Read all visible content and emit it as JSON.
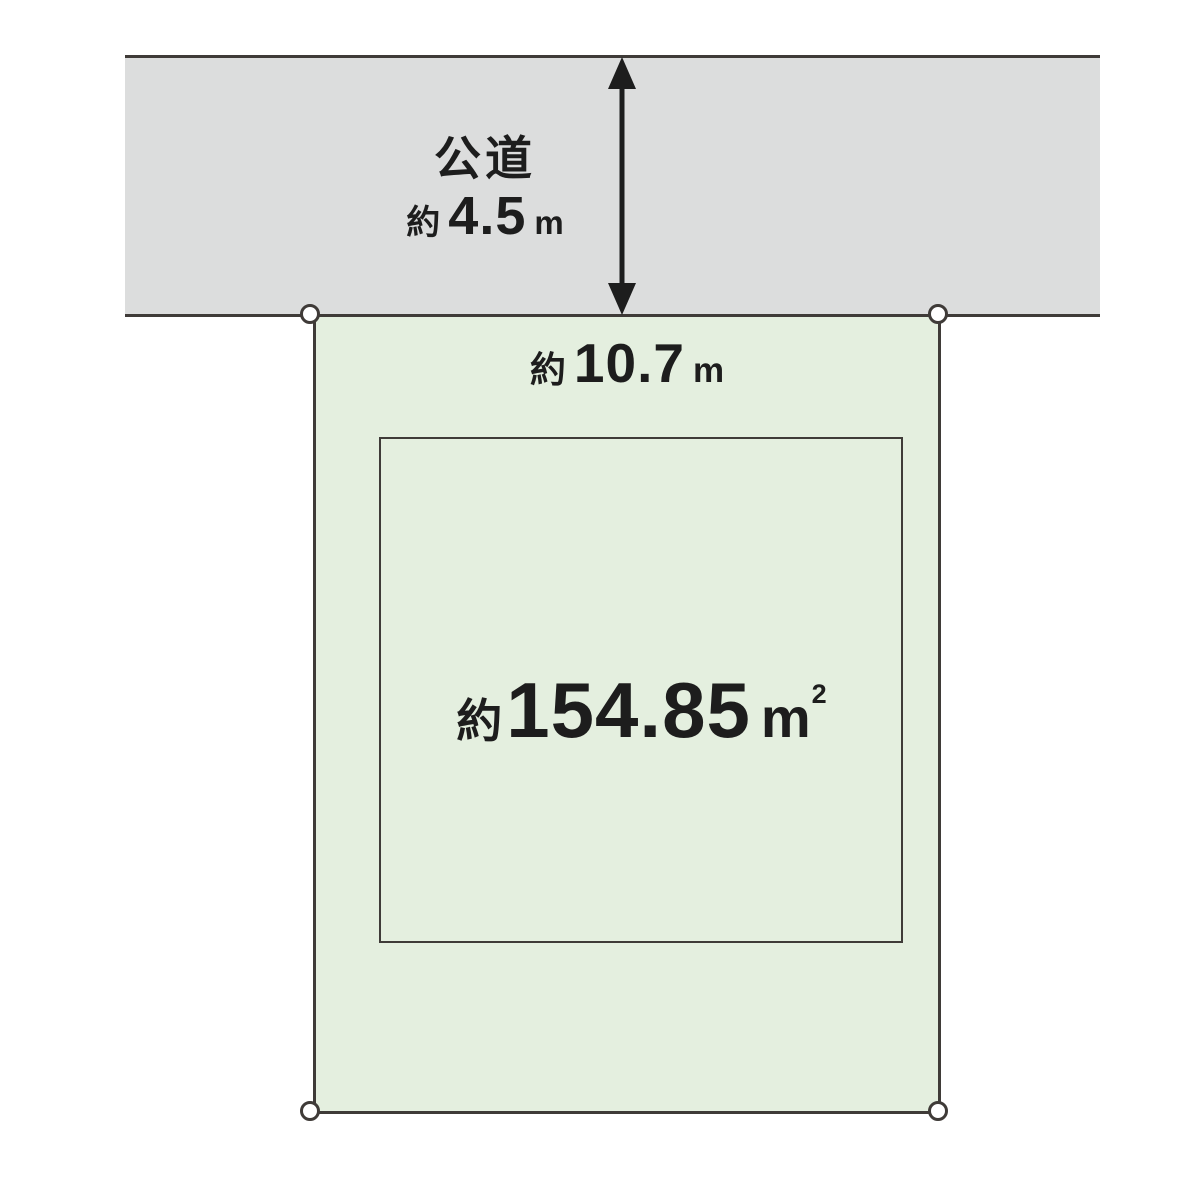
{
  "diagram": {
    "road": {
      "label": "公道",
      "width_prefix": "約",
      "width_value": "4.5",
      "width_unit": "m"
    },
    "frontage": {
      "prefix": "約",
      "value": "10.7",
      "unit": "m"
    },
    "area": {
      "prefix": "約",
      "value": "154.85",
      "unit": "m",
      "unit_sup": "2"
    },
    "colors": {
      "road_fill": "#dcdddd",
      "plot_fill": "#e4efdf",
      "line": "#3f3b38",
      "text": "#1d1d1d",
      "marker_fill": "#ffffff"
    }
  }
}
